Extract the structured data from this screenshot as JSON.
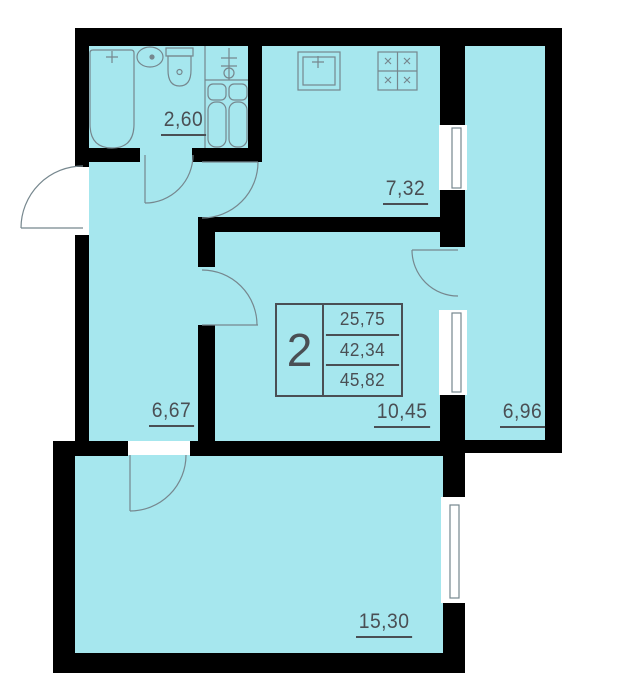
{
  "plan_title": "2-room apartment floor plan",
  "labels": {
    "bathroom": "2,60",
    "kitchen": "7,32",
    "hallway": "6,67",
    "room": "10,45",
    "balcony": "6,96",
    "living_room": "15,30"
  },
  "info_box": {
    "unit": "2",
    "area_values": [
      "25,75",
      "42,34",
      "45,82"
    ]
  },
  "fixtures": {
    "bathroom": [
      "bathtub",
      "washbasin",
      "toilet",
      "heating-risers",
      "shutoff-valve"
    ],
    "kitchen": [
      "kitchen-sink",
      "stove"
    ]
  },
  "colors": {
    "room_fill": "#a6e7ee",
    "wall": "#000000",
    "line": "#76878e",
    "text": "#4a4f54",
    "background": "#ffffff"
  }
}
